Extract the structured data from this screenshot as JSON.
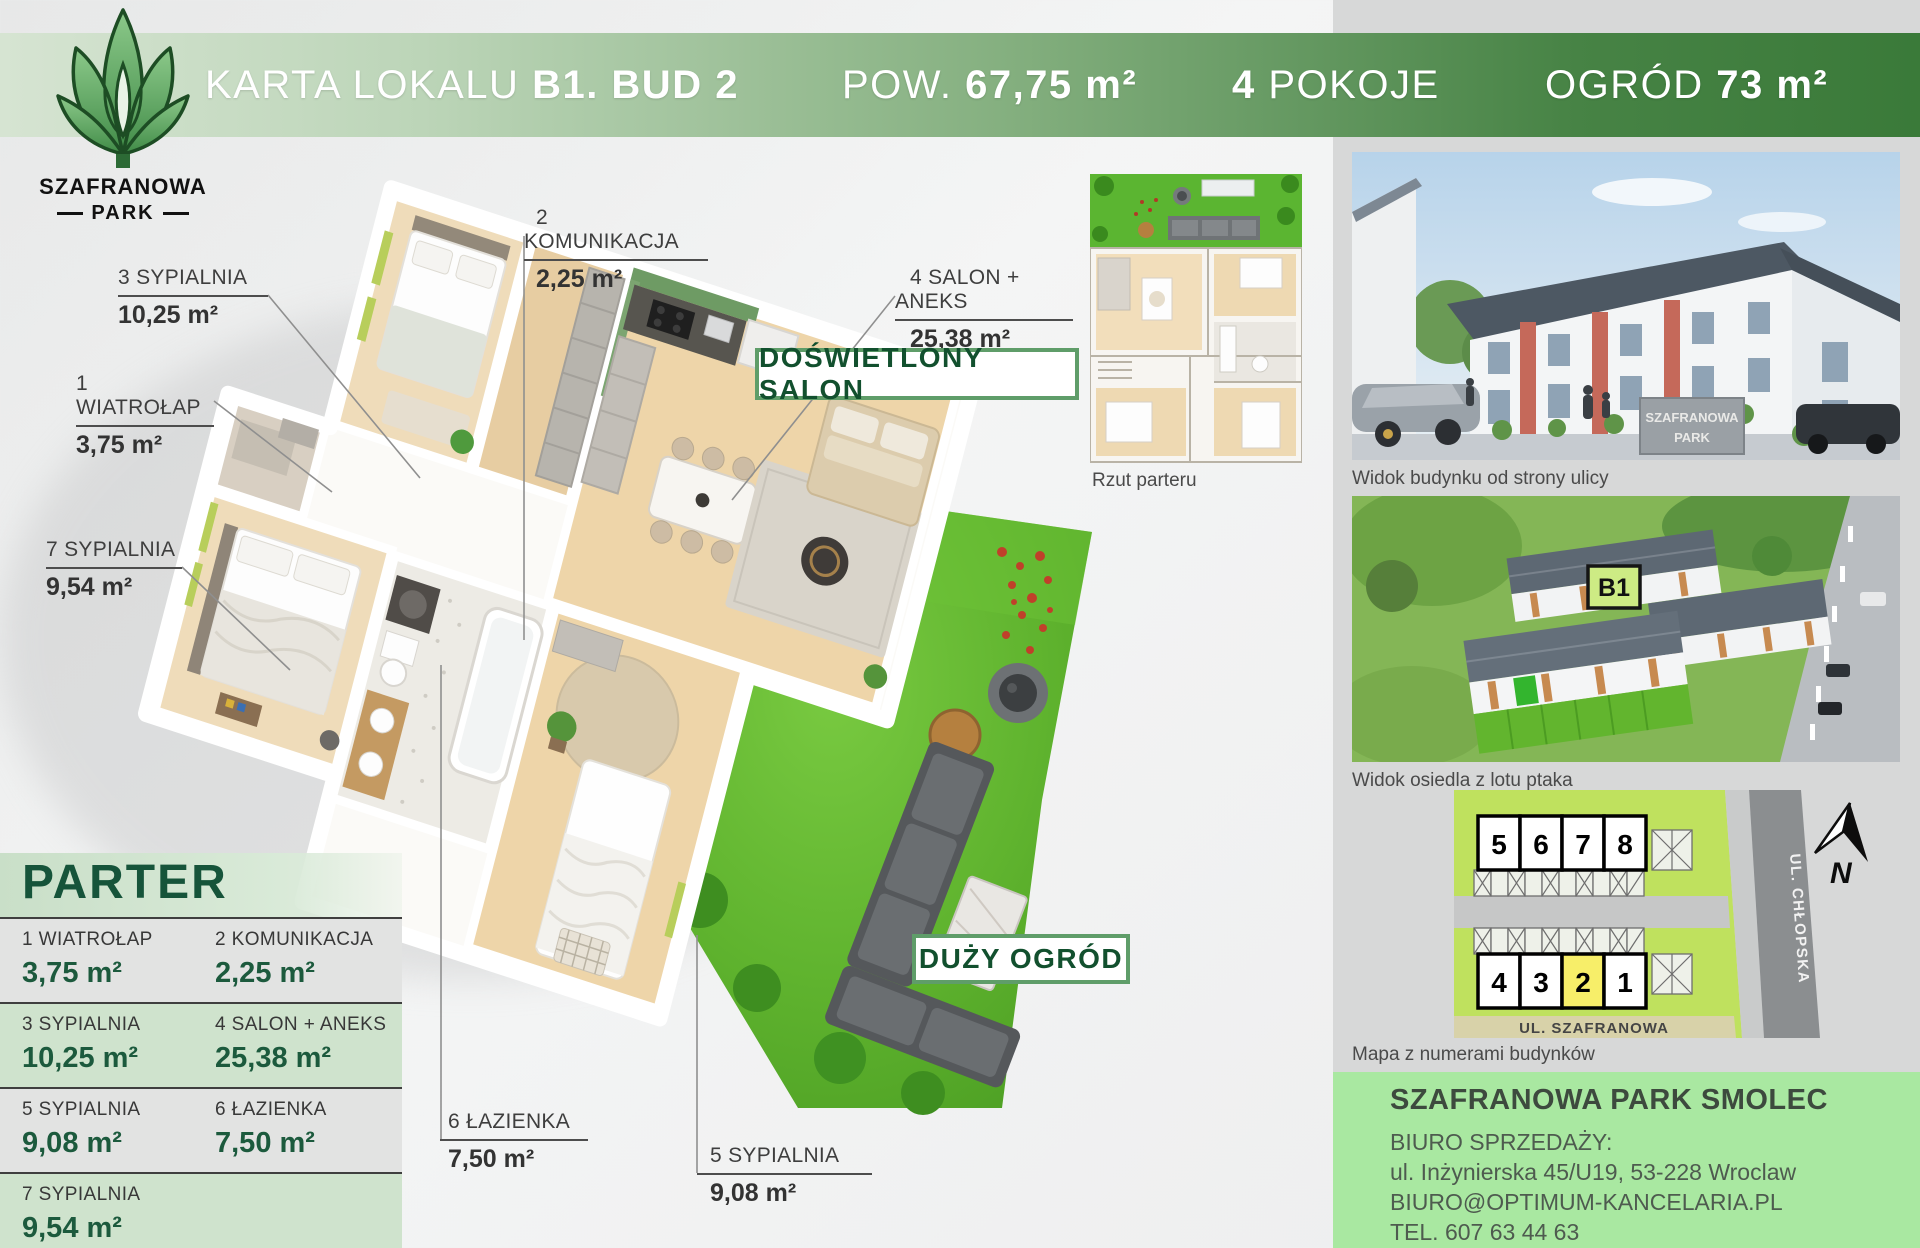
{
  "header": {
    "title_regular": "KARTA LOKALU",
    "title_bold": "B1. BUD 2",
    "area_label": "POW.",
    "area_value": "67,75 m²",
    "rooms_count": "4",
    "rooms_label": "POKOJE",
    "garden_label": "OGRÓD",
    "garden_value": "73 m²"
  },
  "logo": {
    "line1": "SZAFRANOWA",
    "line2": "PARK"
  },
  "rooms": [
    {
      "name": "1 WIATROŁAP",
      "area": "3,75 m²"
    },
    {
      "name": "2 KOMUNIKACJA",
      "area": "2,25 m²"
    },
    {
      "name": "3 SYPIALNIA",
      "area": "10,25 m²"
    },
    {
      "name": "4 SALON + ANEKS",
      "area": "25,38 m²"
    },
    {
      "name": "5 SYPIALNIA",
      "area": "9,08 m²"
    },
    {
      "name": "6 ŁAZIENKA",
      "area": "7,50 m²"
    },
    {
      "name": "7 SYPIALNIA",
      "area": "9,54 m²"
    }
  ],
  "plan": {
    "badge_salon": "DOŚWIETLONY SALON",
    "badge_garden": "DUŻY OGRÓD",
    "mini_plan_caption": "Rzut parteru"
  },
  "floor_panel": {
    "title": "PARTER"
  },
  "sidebar": {
    "photo1_caption": "Widok budynku od strony ulicy",
    "photo1_sign_line1": "SZAFRANOWA",
    "photo1_sign_line2": "PARK",
    "photo2_caption": "Widok osiedla z lotu ptaka",
    "photo2_badge": "B1",
    "map_caption": "Mapa z numerami budynków",
    "map": {
      "top_row": [
        "5",
        "6",
        "7",
        "8"
      ],
      "bottom_row": [
        "4",
        "3",
        "2",
        "1"
      ],
      "highlighted_building": "2",
      "street_right": "UL. CHŁOPSKA",
      "street_bottom": "UL. SZAFRANOWA",
      "compass_label": "N"
    },
    "contact": {
      "title": "SZAFRANOWA PARK SMOLEC",
      "line1": "BIURO SPRZEDAŻY:",
      "line2": "ul. Inżynierska 45/U19, 53-228 Wroclaw",
      "line3": "BIURO@OPTIMUM-KANCELARIA.PL",
      "line4": "TEL. 607 63 44 63"
    }
  },
  "colors": {
    "header_green_dark": "#3a7a39",
    "header_green_light": "#d6e4d2",
    "badge_border_green": "#5f9d69",
    "badge_text_green": "#12502e",
    "panel_title_green": "#16543a",
    "table_row_green": "#cfe3cd",
    "contact_green": "#a9e8a1",
    "map_highlight_yellow": "#f7ee69",
    "grass_green": "#5fb32e"
  }
}
